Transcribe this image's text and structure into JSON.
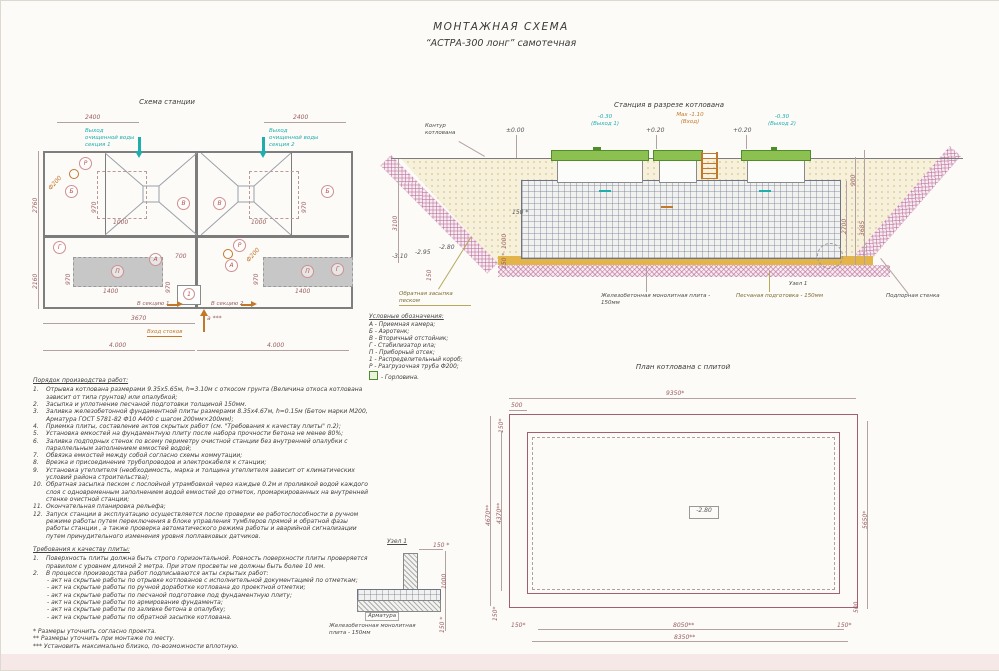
{
  "page": {
    "title1": "МОНТАЖНАЯ СХЕМА",
    "title2": "“АСТРА-300 лонг” самотечная"
  },
  "plan": {
    "title": "Схема станции",
    "dim2400a": "2400",
    "dim2400b": "2400",
    "outlet1": "Выход очищенной воды секция 1",
    "outlet2": "Выход очищенной воды секция 2",
    "dim2760": "2760",
    "dim2160": "2160",
    "dim970": "970",
    "dim1000": "1000",
    "dim1400": "1400",
    "dim700": "700",
    "f200": "Ф200",
    "A": "А",
    "B": "Б",
    "V": "В",
    "G": "Г",
    "P": "П",
    "R": "Р",
    "one": "1",
    "sec1": "В секцию 1",
    "sec2": "В секцию 2",
    "dim3670": "3670",
    "dimA": "а ***",
    "inlet": "Вход стоков",
    "dim4000a": "4.000",
    "dim4000b": "4.000"
  },
  "section": {
    "title": "Станция в разрезе котлована",
    "contour": "Контур котлована",
    "elev0": "±0.00",
    "out1": "-0.30",
    "out1sub": "(Выход 1)",
    "p020a": "+0.20",
    "p020b": "+0.20",
    "max": "Max -1.10",
    "maxsub": "(Вход)",
    "out2": "-0.30",
    "out2sub": "(Выход 2)",
    "dim3100": "3100",
    "dim900": "900",
    "dim2700": "2700",
    "dim3685": "3685",
    "em310": "-3.10",
    "em295": "-2.95",
    "em280": "-2.80",
    "dim150s_h": "150 *",
    "dim1000": "1000",
    "dim150s_v": "150 *",
    "dim150": "150",
    "backfill": "Обратная засыпка песком",
    "slab": "Железобетонная монолитная плита - 150мм",
    "sand": "Песчаная подготовка - 150мм",
    "wall": "Подпорная стенка",
    "node": "Узел 1"
  },
  "legend": {
    "title": "Условные обозначения:",
    "items": [
      "А - Приемная камера;",
      "Б - Аэротенк;",
      "В - Вторичный отстойник;",
      "Г - Стабилизатор ила;",
      "П - Приборный отсек;",
      "1 - Распределительный короб;",
      "Р - Разгрузочная труба Ф200;",
      "-  Горловина."
    ]
  },
  "work_order": {
    "title": "Порядок производства работ:",
    "items": [
      {
        "n": "1.",
        "t": "Отрывка котлована размерами 9.35х5.65м, h=3.10м с откосом грунта (Величина откоса котлована зависит от типа грунтов) или опалубкой;"
      },
      {
        "n": "2.",
        "t": "Засыпка и уплотнение песчаной подготовки толщиной 150мм."
      },
      {
        "n": "3.",
        "t": "Заливка железобетонной фундаментной плиты размерами 8.35х4.67м, h=0.15м (Бетон марки М200, Арматура ГОСТ 5781-82 Ф10 А400 с шагом 200мм×200мм);"
      },
      {
        "n": "4.",
        "t": "Приемка плиты, составление актов скрытых работ (см. \"Требования к качеству плиты\" п.2);"
      },
      {
        "n": "5.",
        "t": "Установка емкостей на фундаментную плиту после набора прочности бетона не менее 80%;"
      },
      {
        "n": "6.",
        "t": "Заливка подпорных стенок по всему периметру очистной станции без внутренней опалубки с параллельным заполнением емкостей водой;"
      },
      {
        "n": "7.",
        "t": "Обвязка емкостей между собой согласно схемы коммутации;"
      },
      {
        "n": "8.",
        "t": "Врезка и присоединение трубопроводов и электрокабеля к станции;"
      },
      {
        "n": "9.",
        "t": "Установка утеплителя (необходимость, марка и толщина утеплителя зависит от климатических условий района строительства);"
      },
      {
        "n": "10.",
        "t": "Обратная засыпка песком с послойной утрамбовкой через каждые 0.2м и проливкой водой каждого слоя с одновременным заполнением водой емкостей до отметок, промаркированных на внутренней стенке очистной станции;"
      },
      {
        "n": "11.",
        "t": "Окончательная планировка рельефа;"
      },
      {
        "n": "12.",
        "t": "Запуск станции в эксплуатацию осуществляется после проверки ее работоспособности в ручном режиме работы путем переключения в блоке управления тумблеров прямой и обратной фазы работы станции , а также проверка автоматического режима работы и аварийной сигнализации путем принудительного изменения уровня поплавковых датчиков."
      }
    ]
  },
  "quality": {
    "title": "Требования к качеству плиты:",
    "items": [
      {
        "n": "1.",
        "t": "Поверхность плиты должна быть строго горизонтальной. Ровность поверхности плиты проверяется правилом с уровнем длиной 2 метра. При этом просветы не должны быть более 10 мм."
      },
      {
        "n": "2.",
        "t": "В процессе производства работ подписываются акты скрытых работ:"
      }
    ],
    "acts": [
      "- акт на скрытые работы по отрывке котлованов с исполнительной документацией по отметкам;",
      "- акт на скрытые работы по ручной доработке котлована до проектной отметки;",
      "- акт на скрытые работы по песчаной подготовке под фундаментную плиту;",
      "- акт на скрытые работы по армирование фундамента;",
      "- акт на скрытые работы по заливке бетона в опалубку;",
      "- акт на скрытые работы по обратной засыпке котлована."
    ]
  },
  "footnotes": [
    "* Размеры уточнить согласно проекта.",
    "** Размеры уточнить при монтаже по месту.",
    "*** Установить максимально близко, по-возможности вплотную."
  ],
  "node_detail": {
    "title": "Узел 1",
    "rebar": "Арматура",
    "slab": "Железобетонная монолитная плита - 150мм",
    "dtop": "150 *",
    "dmid": "1000",
    "dbot": "150 *"
  },
  "pit_plan": {
    "title": "План котлована с плитой",
    "d9350": "9350*",
    "d500t": "500",
    "d150t": "150*",
    "d4670": "4670**",
    "d4370": "4370**",
    "d5650": "5650*",
    "d500r": "500",
    "d150bl": "150*",
    "d8050": "8050**",
    "d150br": "150*",
    "d8350": "8350**",
    "d150l": "150*",
    "elev": "-2.80"
  }
}
